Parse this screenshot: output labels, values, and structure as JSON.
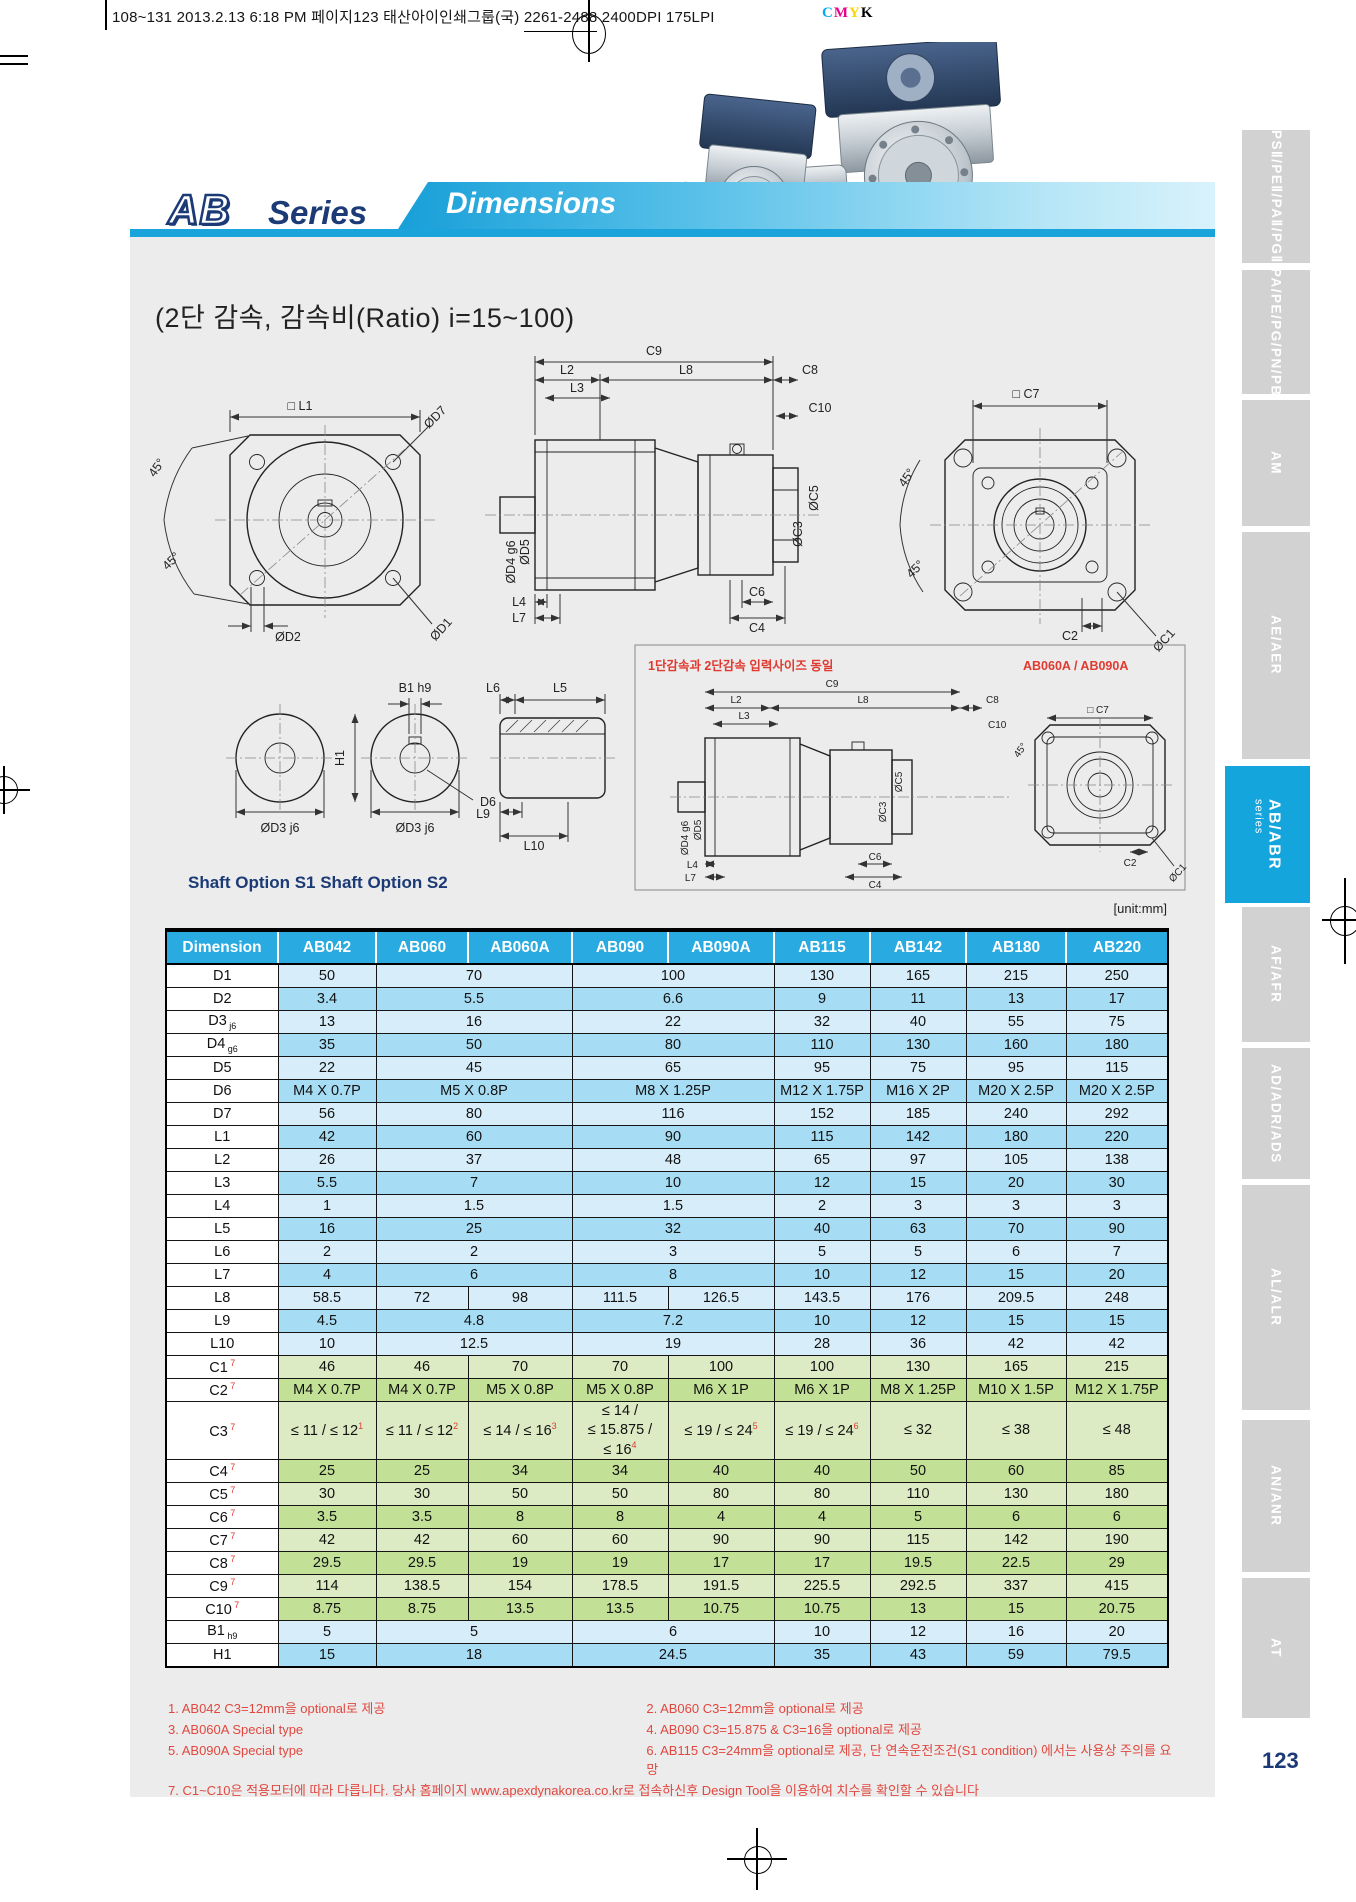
{
  "print_header": {
    "part1": "108~131  2013.2.13 6:18 PM  페이지123   태산아이인쇄그룹(국) ",
    "underlined": "2261-2488",
    "part2": "  2400DPI 175LPI",
    "cmyk": [
      "C",
      "M",
      "Y",
      "K"
    ],
    "cmyk_colors": {
      "C": "#00aeef",
      "M": "#ec008c",
      "Y": "#f5d800",
      "K": "#000000"
    }
  },
  "header": {
    "logo_ab": "AB",
    "logo_series": "Series",
    "banner": "Dimensions"
  },
  "subtitle": "(2단 감속, 감속비(Ratio) i=15~100)",
  "diagrams": {
    "unit_note": "[unit:mm]",
    "red_note": "1단감속과 2단감속 입력사이즈 동일",
    "red_note_models": "AB060A / AB090A",
    "shaft_options": "Shaft Option S1  Shaft Option S2",
    "labels": {
      "l1": "□ L1",
      "d7": "ØD7",
      "deg45": "45°",
      "d2": "ØD2",
      "d1": "ØD1",
      "c9": "C9",
      "l2": "L2",
      "l8": "L8",
      "c8": "C8",
      "l3": "L3",
      "c10": "C10",
      "d4": "ØD4 g6",
      "d5": "ØD5",
      "c5": "ØC5",
      "c3": "ØC3",
      "c6": "C6",
      "c4": "C4",
      "l4": "L4",
      "l7": "L7",
      "c7": "□ C7",
      "c2": "C2",
      "c1": "ØC1",
      "b1": "B1 h9",
      "h1": "H1",
      "d3": "ØD3 j6",
      "d6": "D6",
      "l6": "L6",
      "l5": "L5",
      "l9": "L9",
      "l10": "L10"
    }
  },
  "table": {
    "headers": [
      "Dimension",
      "AB042",
      "AB060",
      "AB060A",
      "AB090",
      "AB090A",
      "AB115",
      "AB142",
      "AB180",
      "AB220"
    ],
    "rows": [
      {
        "label": "D1",
        "group": "blue",
        "cells": [
          [
            "50",
            1
          ],
          [
            "70",
            2
          ],
          [
            "100",
            2
          ],
          [
            "130",
            1
          ],
          [
            "165",
            1
          ],
          [
            "215",
            1
          ],
          [
            "250",
            1
          ]
        ]
      },
      {
        "label": "D2",
        "group": "blue",
        "cells": [
          [
            "3.4",
            1
          ],
          [
            "5.5",
            2
          ],
          [
            "6.6",
            2
          ],
          [
            "9",
            1
          ],
          [
            "11",
            1
          ],
          [
            "13",
            1
          ],
          [
            "17",
            1
          ]
        ]
      },
      {
        "label": "D3",
        "sub": "j6",
        "group": "blue",
        "cells": [
          [
            "13",
            1
          ],
          [
            "16",
            2
          ],
          [
            "22",
            2
          ],
          [
            "32",
            1
          ],
          [
            "40",
            1
          ],
          [
            "55",
            1
          ],
          [
            "75",
            1
          ]
        ]
      },
      {
        "label": "D4",
        "sub": "g6",
        "group": "blue",
        "cells": [
          [
            "35",
            1
          ],
          [
            "50",
            2
          ],
          [
            "80",
            2
          ],
          [
            "110",
            1
          ],
          [
            "130",
            1
          ],
          [
            "160",
            1
          ],
          [
            "180",
            1
          ]
        ]
      },
      {
        "label": "D5",
        "group": "blue",
        "cells": [
          [
            "22",
            1
          ],
          [
            "45",
            2
          ],
          [
            "65",
            2
          ],
          [
            "95",
            1
          ],
          [
            "75",
            1
          ],
          [
            "95",
            1
          ],
          [
            "115",
            1
          ]
        ]
      },
      {
        "label": "D6",
        "group": "blue",
        "cells": [
          [
            "M4 X 0.7P",
            1
          ],
          [
            "M5 X 0.8P",
            2
          ],
          [
            "M8 X 1.25P",
            2
          ],
          [
            "M12 X 1.75P",
            1
          ],
          [
            "M16 X 2P",
            1
          ],
          [
            "M20 X 2.5P",
            1
          ],
          [
            "M20 X 2.5P",
            1
          ]
        ]
      },
      {
        "label": "D7",
        "group": "blue",
        "cells": [
          [
            "56",
            1
          ],
          [
            "80",
            2
          ],
          [
            "116",
            2
          ],
          [
            "152",
            1
          ],
          [
            "185",
            1
          ],
          [
            "240",
            1
          ],
          [
            "292",
            1
          ]
        ]
      },
      {
        "label": "L1",
        "group": "blue",
        "cells": [
          [
            "42",
            1
          ],
          [
            "60",
            2
          ],
          [
            "90",
            2
          ],
          [
            "115",
            1
          ],
          [
            "142",
            1
          ],
          [
            "180",
            1
          ],
          [
            "220",
            1
          ]
        ]
      },
      {
        "label": "L2",
        "group": "blue",
        "cells": [
          [
            "26",
            1
          ],
          [
            "37",
            2
          ],
          [
            "48",
            2
          ],
          [
            "65",
            1
          ],
          [
            "97",
            1
          ],
          [
            "105",
            1
          ],
          [
            "138",
            1
          ]
        ]
      },
      {
        "label": "L3",
        "group": "blue",
        "cells": [
          [
            "5.5",
            1
          ],
          [
            "7",
            2
          ],
          [
            "10",
            2
          ],
          [
            "12",
            1
          ],
          [
            "15",
            1
          ],
          [
            "20",
            1
          ],
          [
            "30",
            1
          ]
        ]
      },
      {
        "label": "L4",
        "group": "blue",
        "cells": [
          [
            "1",
            1
          ],
          [
            "1.5",
            2
          ],
          [
            "1.5",
            2
          ],
          [
            "2",
            1
          ],
          [
            "3",
            1
          ],
          [
            "3",
            1
          ],
          [
            "3",
            1
          ]
        ]
      },
      {
        "label": "L5",
        "group": "blue",
        "cells": [
          [
            "16",
            1
          ],
          [
            "25",
            2
          ],
          [
            "32",
            2
          ],
          [
            "40",
            1
          ],
          [
            "63",
            1
          ],
          [
            "70",
            1
          ],
          [
            "90",
            1
          ]
        ]
      },
      {
        "label": "L6",
        "group": "blue",
        "cells": [
          [
            "2",
            1
          ],
          [
            "2",
            2
          ],
          [
            "3",
            2
          ],
          [
            "5",
            1
          ],
          [
            "5",
            1
          ],
          [
            "6",
            1
          ],
          [
            "7",
            1
          ]
        ]
      },
      {
        "label": "L7",
        "group": "blue",
        "cells": [
          [
            "4",
            1
          ],
          [
            "6",
            2
          ],
          [
            "8",
            2
          ],
          [
            "10",
            1
          ],
          [
            "12",
            1
          ],
          [
            "15",
            1
          ],
          [
            "20",
            1
          ]
        ]
      },
      {
        "label": "L8",
        "group": "blue",
        "cells": [
          [
            "58.5",
            1
          ],
          [
            "72",
            1
          ],
          [
            "98",
            1
          ],
          [
            "111.5",
            1
          ],
          [
            "126.5",
            1
          ],
          [
            "143.5",
            1
          ],
          [
            "176",
            1
          ],
          [
            "209.5",
            1
          ],
          [
            "248",
            1
          ]
        ]
      },
      {
        "label": "L9",
        "group": "blue",
        "cells": [
          [
            "4.5",
            1
          ],
          [
            "4.8",
            2
          ],
          [
            "7.2",
            2
          ],
          [
            "10",
            1
          ],
          [
            "12",
            1
          ],
          [
            "15",
            1
          ],
          [
            "15",
            1
          ]
        ]
      },
      {
        "label": "L10",
        "group": "blue",
        "cells": [
          [
            "10",
            1
          ],
          [
            "12.5",
            2
          ],
          [
            "19",
            2
          ],
          [
            "28",
            1
          ],
          [
            "36",
            1
          ],
          [
            "42",
            1
          ],
          [
            "42",
            1
          ]
        ]
      },
      {
        "label": "C1",
        "sup": "7",
        "group": "green",
        "cells": [
          [
            "46",
            1
          ],
          [
            "46",
            1
          ],
          [
            "70",
            1
          ],
          [
            "70",
            1
          ],
          [
            "100",
            1
          ],
          [
            "100",
            1
          ],
          [
            "130",
            1
          ],
          [
            "165",
            1
          ],
          [
            "215",
            1
          ]
        ]
      },
      {
        "label": "C2",
        "sup": "7",
        "group": "green",
        "cells": [
          [
            "M4 X 0.7P",
            1
          ],
          [
            "M4 X 0.7P",
            1
          ],
          [
            "M5 X 0.8P",
            1
          ],
          [
            "M5 X 0.8P",
            1
          ],
          [
            "M6 X 1P",
            1
          ],
          [
            "M6 X 1P",
            1
          ],
          [
            "M8 X 1.25P",
            1
          ],
          [
            "M10 X 1.5P",
            1
          ],
          [
            "M12 X 1.75P",
            1
          ]
        ]
      },
      {
        "label": "C3",
        "sup": "7",
        "tall": true,
        "group": "green",
        "cells": [
          [
            "≤ 11 / ≤ 12",
            1,
            "1"
          ],
          [
            "≤ 11 / ≤ 12",
            1,
            "2"
          ],
          [
            "≤ 14 / ≤ 16",
            1,
            "3"
          ],
          [
            "≤ 14 /\n≤ 15.875 /\n≤ 16",
            1,
            "4"
          ],
          [
            "≤ 19 / ≤ 24",
            1,
            "5"
          ],
          [
            "≤ 19 / ≤ 24",
            1,
            "6"
          ],
          [
            "≤ 32",
            1
          ],
          [
            "≤ 38",
            1
          ],
          [
            "≤ 48",
            1
          ]
        ]
      },
      {
        "label": "C4",
        "sup": "7",
        "group": "green",
        "cells": [
          [
            "25",
            1
          ],
          [
            "25",
            1
          ],
          [
            "34",
            1
          ],
          [
            "34",
            1
          ],
          [
            "40",
            1
          ],
          [
            "40",
            1
          ],
          [
            "50",
            1
          ],
          [
            "60",
            1
          ],
          [
            "85",
            1
          ]
        ]
      },
      {
        "label": "C5",
        "sup": "7",
        "group": "green",
        "cells": [
          [
            "30",
            1
          ],
          [
            "30",
            1
          ],
          [
            "50",
            1
          ],
          [
            "50",
            1
          ],
          [
            "80",
            1
          ],
          [
            "80",
            1
          ],
          [
            "110",
            1
          ],
          [
            "130",
            1
          ],
          [
            "180",
            1
          ]
        ]
      },
      {
        "label": "C6",
        "sup": "7",
        "group": "green",
        "cells": [
          [
            "3.5",
            1
          ],
          [
            "3.5",
            1
          ],
          [
            "8",
            1
          ],
          [
            "8",
            1
          ],
          [
            "4",
            1
          ],
          [
            "4",
            1
          ],
          [
            "5",
            1
          ],
          [
            "6",
            1
          ],
          [
            "6",
            1
          ]
        ]
      },
      {
        "label": "C7",
        "sup": "7",
        "group": "green",
        "cells": [
          [
            "42",
            1
          ],
          [
            "42",
            1
          ],
          [
            "60",
            1
          ],
          [
            "60",
            1
          ],
          [
            "90",
            1
          ],
          [
            "90",
            1
          ],
          [
            "115",
            1
          ],
          [
            "142",
            1
          ],
          [
            "190",
            1
          ]
        ]
      },
      {
        "label": "C8",
        "sup": "7",
        "group": "green",
        "cells": [
          [
            "29.5",
            1
          ],
          [
            "29.5",
            1
          ],
          [
            "19",
            1
          ],
          [
            "19",
            1
          ],
          [
            "17",
            1
          ],
          [
            "17",
            1
          ],
          [
            "19.5",
            1
          ],
          [
            "22.5",
            1
          ],
          [
            "29",
            1
          ]
        ]
      },
      {
        "label": "C9",
        "sup": "7",
        "group": "green",
        "cells": [
          [
            "114",
            1
          ],
          [
            "138.5",
            1
          ],
          [
            "154",
            1
          ],
          [
            "178.5",
            1
          ],
          [
            "191.5",
            1
          ],
          [
            "225.5",
            1
          ],
          [
            "292.5",
            1
          ],
          [
            "337",
            1
          ],
          [
            "415",
            1
          ]
        ]
      },
      {
        "label": "C10",
        "sup": "7",
        "group": "green",
        "cells": [
          [
            "8.75",
            1
          ],
          [
            "8.75",
            1
          ],
          [
            "13.5",
            1
          ],
          [
            "13.5",
            1
          ],
          [
            "10.75",
            1
          ],
          [
            "10.75",
            1
          ],
          [
            "13",
            1
          ],
          [
            "15",
            1
          ],
          [
            "20.75",
            1
          ]
        ]
      },
      {
        "label": "B1",
        "sub": "h9",
        "group": "blue",
        "cells": [
          [
            "5",
            1
          ],
          [
            "5",
            2
          ],
          [
            "6",
            2
          ],
          [
            "10",
            1
          ],
          [
            "12",
            1
          ],
          [
            "16",
            1
          ],
          [
            "20",
            1
          ]
        ]
      },
      {
        "label": "H1",
        "group": "blue",
        "cells": [
          [
            "15",
            1
          ],
          [
            "18",
            2
          ],
          [
            "24.5",
            2
          ],
          [
            "35",
            1
          ],
          [
            "43",
            1
          ],
          [
            "59",
            1
          ],
          [
            "79.5",
            1
          ]
        ]
      }
    ]
  },
  "footnotes": [
    "1. AB042  C3=12mm을 optional로 제공",
    "2. AB060  C3=12mm을 optional로 제공",
    "3. AB060A  Special type",
    "4. AB090  C3=15.875 & C3=16을 optional로 제공",
    "5. AB090A  Special type",
    "6. AB115  C3=24mm을 optional로 제공, 단 연속운전조건(S1 condition) 에서는 사용상 주의를 요망",
    "7. C1~C10은 적용모터에 따라 다릅니다. 당사 홈페이지 www.apexdynakorea.co.kr로 접속하신후 Design Tool을 이용하여 치수를 확인할 수 있습니다"
  ],
  "sidebar": {
    "tabs": [
      {
        "label": "PSⅡ/PEⅡ/PAⅡ/PGⅡ"
      },
      {
        "label": "PA/PE/PG/PN/PB"
      },
      {
        "label": "AM"
      },
      {
        "label": "AE/AER"
      },
      {
        "label": "AB/ABR",
        "sublabel": "series",
        "active": true
      },
      {
        "label": "AF/AFR"
      },
      {
        "label": "AD/ADR/ADS"
      },
      {
        "label": "AL/ALR"
      },
      {
        "label": "AN/ANR"
      },
      {
        "label": "AT"
      }
    ]
  },
  "page_number": "123",
  "colors": {
    "accent_cyan": "#29abe2",
    "navy": "#1b3a76",
    "red": "#e03a30",
    "row_blue_light": "#d7eefa",
    "row_blue_dark": "#a6ddf4",
    "row_green_light": "#dcebc4",
    "row_green_dark": "#c2e096",
    "panel_gray": "#ececec",
    "tab_gray": "#d2d2d2"
  }
}
